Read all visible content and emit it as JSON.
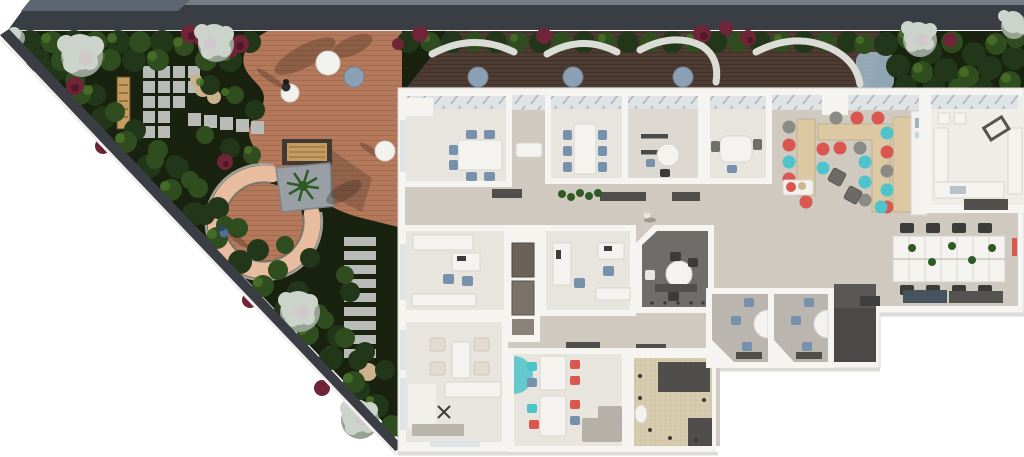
{
  "scene": {
    "type": "architectural-floor-plan-render",
    "view": "top-down-3d",
    "people_outdoors": 2,
    "people_indoors": 1
  },
  "palette": {
    "white": "#ffffff",
    "roof_slab": "#5d6573",
    "roof_band": "#3a3d43",
    "roof_edge": "#767b85",
    "trim": "#e9e8e4",
    "garden_base": "#18220f",
    "bush_dark": "#22371a",
    "bush_mid": "#2f4d1e",
    "bush_light": "#4a7229",
    "burgundy": "#6f2438",
    "burgundy_dark": "#4a1624",
    "tree_pale": "#ccd3cb",
    "tree_shade": "#97a295",
    "tree_pink": "#d3bfcb",
    "deck": "#b4785a",
    "deck_plank": "#7a4f3a",
    "terrace_deck": "#4e3c33",
    "bench_white": "#dadcd6",
    "table_blue": "#8ba0b4",
    "water": "#9db4c4",
    "ring_rim": "#e8bd9f",
    "ring_edge": "#a3a09b",
    "paver": "#b8bbb7",
    "rock": "#c9b28c",
    "bench_wood": "#c79a5f",
    "pergola_frame": "#3f3a33",
    "palm": "#2e5a25",
    "planter": "#999fa5",
    "wall": "#f5f4f1",
    "wall_shadow": "#dad7d1",
    "floor": "#cfc9c0",
    "floor_light": "#e8e5df",
    "floor_grey": "#bab5ae",
    "floor_dark": "#6f6d69",
    "glass": "#dee4e6",
    "mullion": "#9aa0a4",
    "chair_blue": "#7790ab",
    "chair_dark": "#3b3b39",
    "chair_cream": "#e2dcd0",
    "sofa_grey": "#b5b0a8",
    "counter": "#dcc9a4",
    "counter_edge": "#c3b08a",
    "stool_red": "#d9574f",
    "stool_teal": "#4cc4c9",
    "stool_grey": "#8b8b85",
    "tile": "#d8ccb0",
    "tile_line": "#c4b694",
    "dark_unit": "#504e4a",
    "storage": "#4b4947",
    "storage_top": "#5a5855",
    "mat": "#514f4c",
    "credenza": "#46535e",
    "kitchen_floor": "#efede7",
    "table_white": "#f4f3ef",
    "table_edge": "#d8d5cf",
    "person_blue": "#4d6e9e",
    "person_dark": "#2e2e30",
    "person_pale": "#e8e6e2",
    "shadow": "rgba(50,38,28,0.30)",
    "ext_shadow": "#dcdbd8"
  },
  "garden": {
    "surface": "wood-deck-terrace",
    "features": [
      "curved-seating-ring",
      "pergola-bench",
      "palm-planter",
      "stone-paver-grid",
      "stepping-stone-path",
      "garden-bench",
      "boulders"
    ],
    "planting": [
      "evergreen-shrubs",
      "white-flowering-trees",
      "burgundy-shrubs"
    ],
    "terrace_furniture": {
      "curved_benches": 4,
      "round_tables": 4,
      "umbrella_tables": 3
    }
  },
  "building": {
    "rooms": [
      {
        "id": "meeting-room-1"
      },
      {
        "id": "meeting-room-2"
      },
      {
        "id": "meeting-room-3"
      },
      {
        "id": "meeting-room-4"
      },
      {
        "id": "cafe-lounge"
      },
      {
        "id": "kitchen-pantry"
      },
      {
        "id": "communal-table-area"
      },
      {
        "id": "office-1"
      },
      {
        "id": "office-2"
      },
      {
        "id": "focus-room"
      },
      {
        "id": "lounge"
      },
      {
        "id": "staff-cafeteria"
      },
      {
        "id": "restroom"
      },
      {
        "id": "phone-booth-1"
      },
      {
        "id": "phone-booth-2"
      },
      {
        "id": "storage-room"
      },
      {
        "id": "open-office"
      }
    ],
    "cafe_stools": {
      "red": 9,
      "teal": 7,
      "grey": 5
    }
  }
}
